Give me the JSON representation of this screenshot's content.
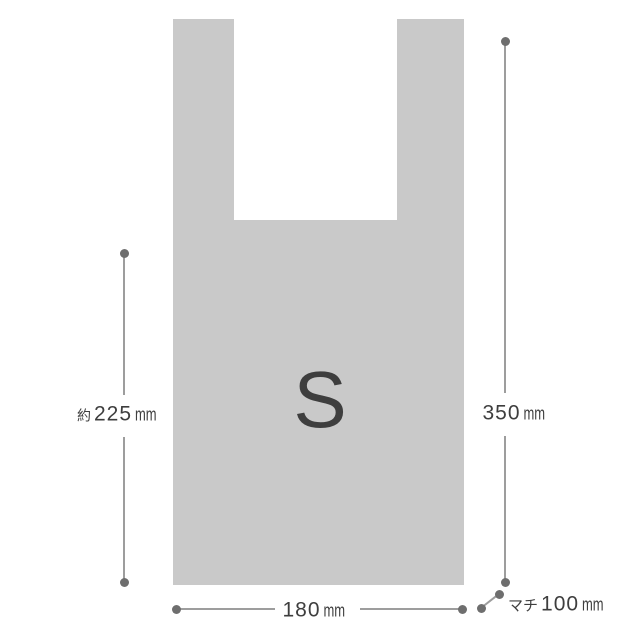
{
  "diagram": {
    "size_letter": "S",
    "dimensions": {
      "left_height": {
        "prefix": "約",
        "value": "225",
        "unit": "mm"
      },
      "right_height": {
        "value": "350",
        "unit": "mm"
      },
      "bottom_width": {
        "value": "180",
        "unit": "mm"
      },
      "gusset": {
        "prefix": "マチ",
        "value": "100",
        "unit": "mm"
      }
    },
    "colors": {
      "background": "#ffffff",
      "bag_fill": "#c9c9c9",
      "dimension_line": "#9d9d9d",
      "dimension_dot": "#6e6e6e",
      "text": "#3e3e3e"
    }
  }
}
